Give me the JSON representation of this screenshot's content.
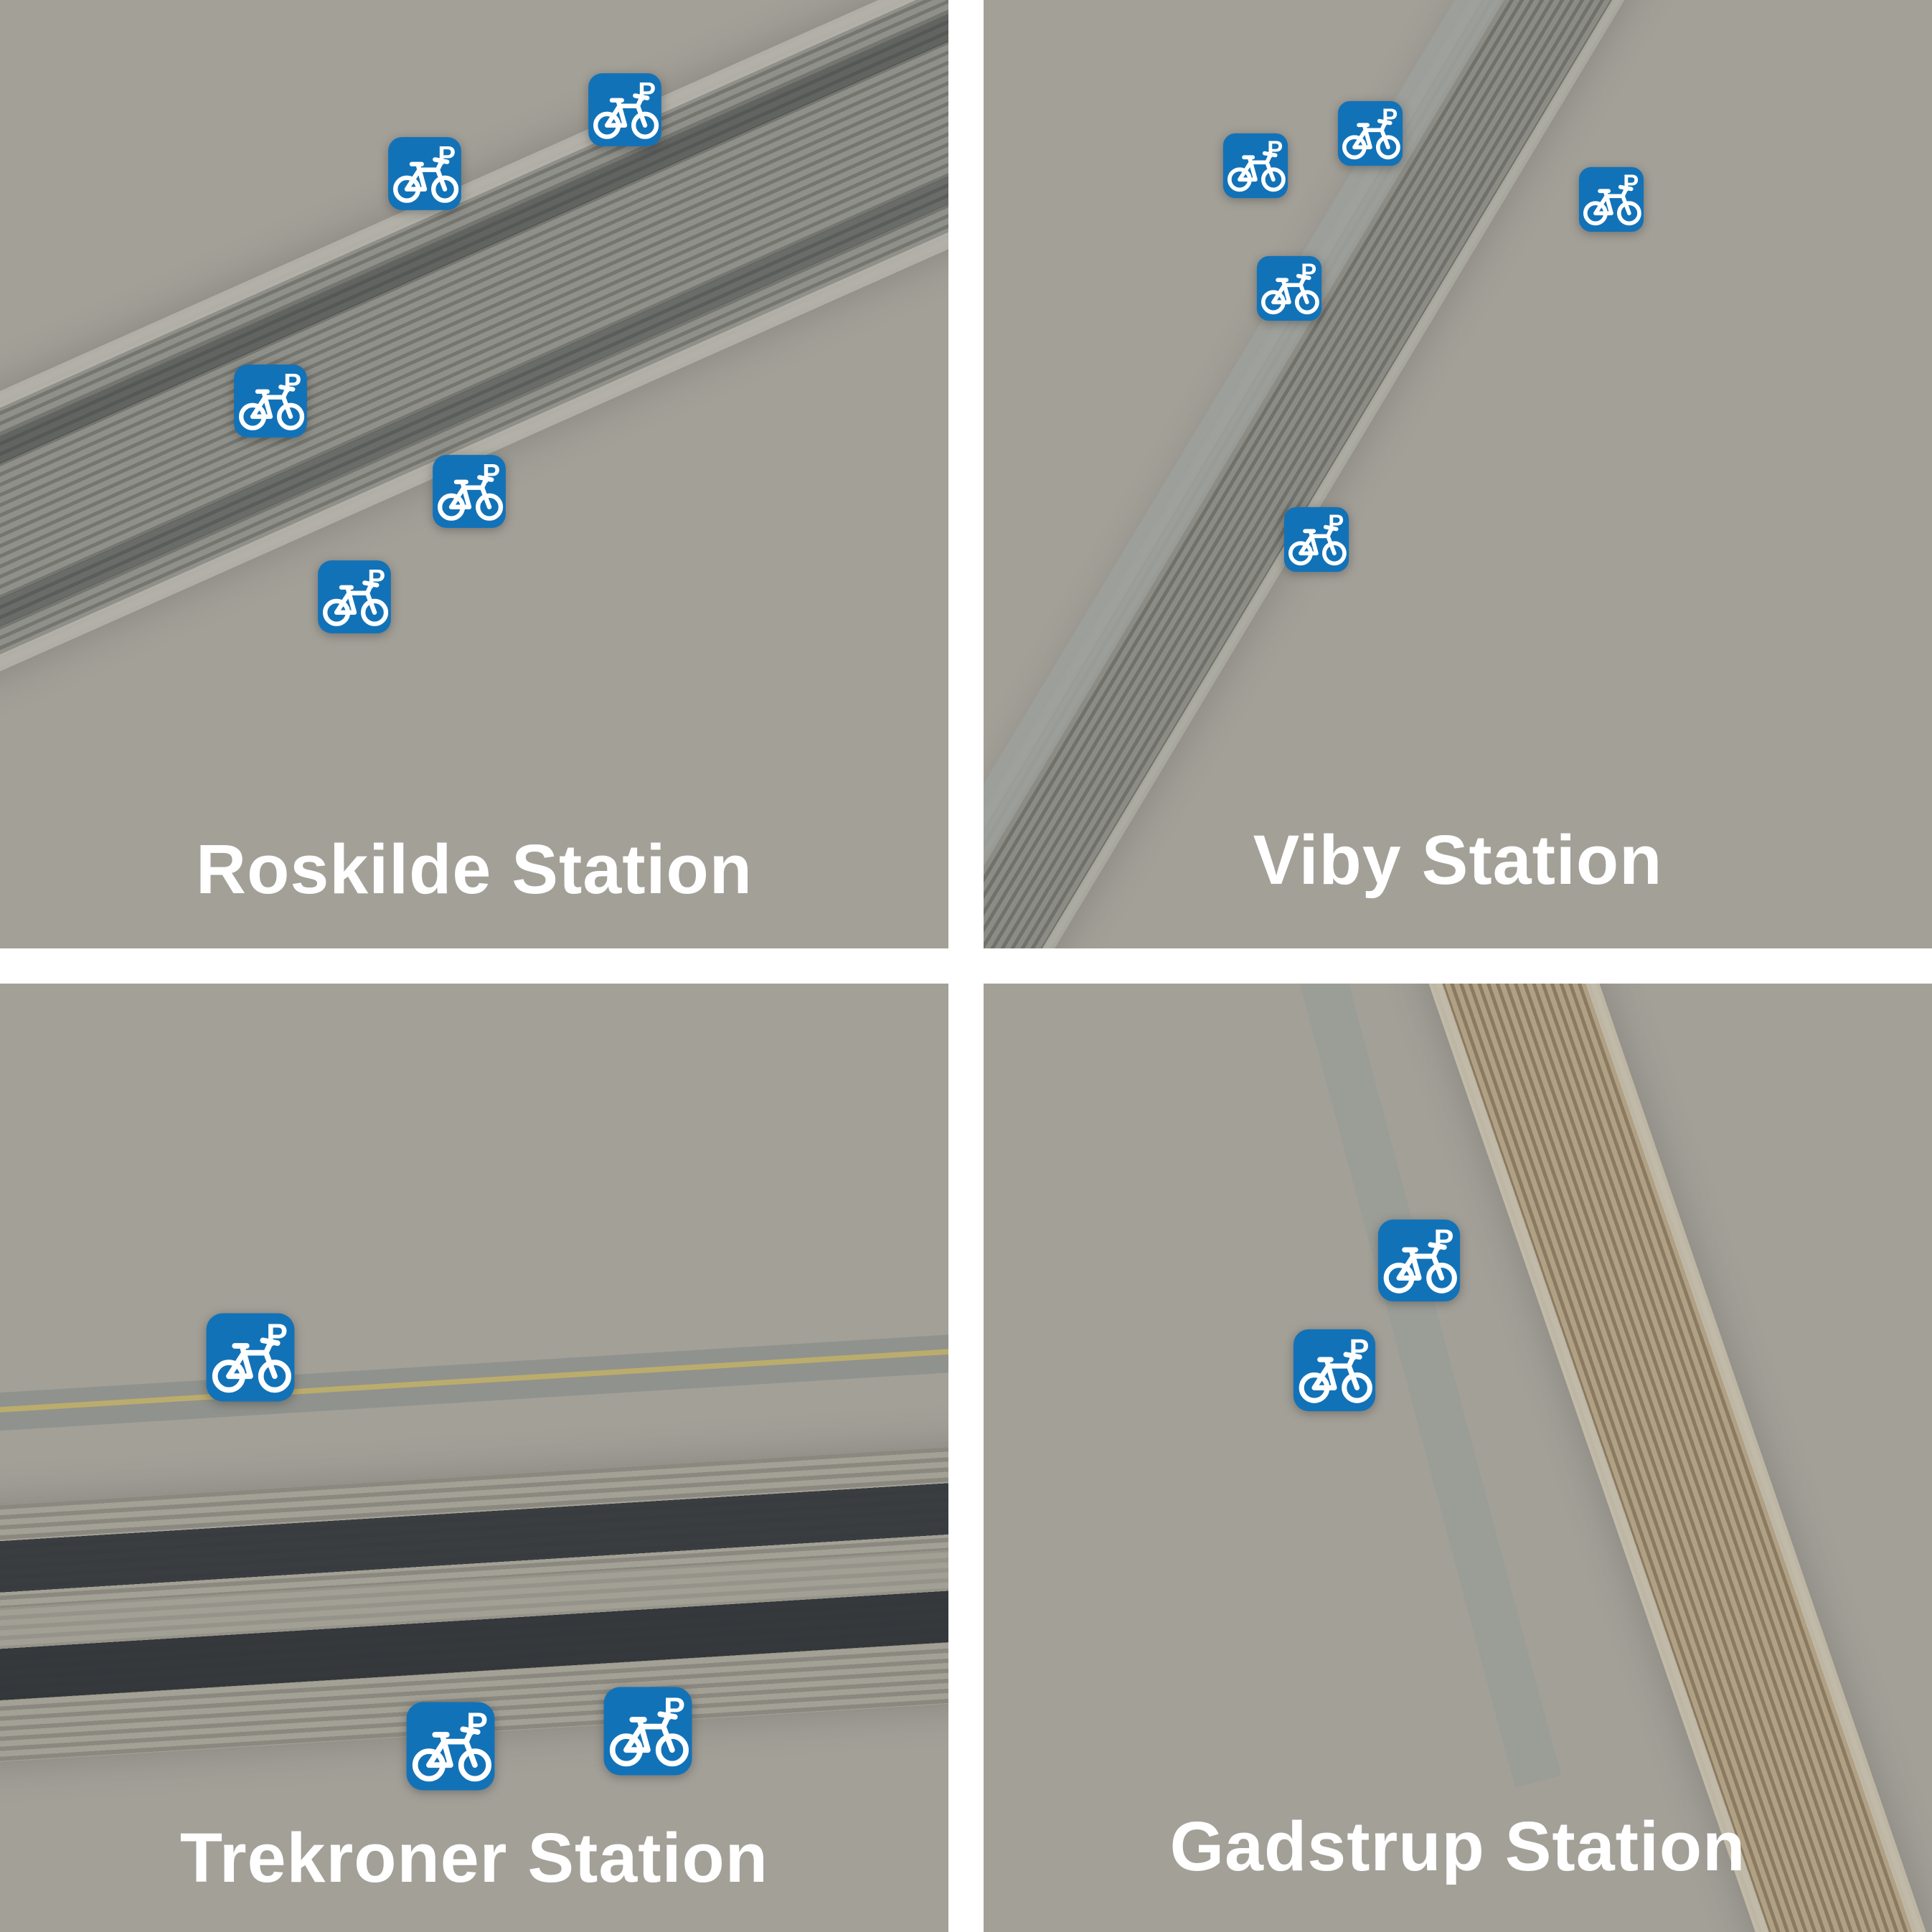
{
  "page": {
    "type": "bike-parking-stations-overview",
    "grid": "2x2"
  },
  "colors": {
    "accent_blue": "#1272b8",
    "icon_glyph": "#ffffff",
    "station_label": "#ffffff",
    "gutter": "#ffffff"
  },
  "marker": {
    "kind": "bicycle-parking-sign",
    "p_label": "P"
  },
  "quadrants": [
    {
      "id": "roskilde",
      "type": "aerial-orthophoto",
      "label": "Roskilde Station",
      "label_pos": {
        "x": 50,
        "y": 91.7
      },
      "marker_size_px": 106,
      "markers": [
        {
          "x": 65.9,
          "y": 11.6
        },
        {
          "x": 44.8,
          "y": 18.3
        },
        {
          "x": 28.5,
          "y": 42.3
        },
        {
          "x": 49.5,
          "y": 51.8
        },
        {
          "x": 37.4,
          "y": 62.9
        }
      ]
    },
    {
      "id": "viby",
      "type": "aerial-orthophoto",
      "label": "Viby Station",
      "label_pos": {
        "x": 49.3,
        "y": 90.7
      },
      "marker_size_px": 94,
      "markers": [
        {
          "x": 40.8,
          "y": 14.1
        },
        {
          "x": 28.7,
          "y": 17.5
        },
        {
          "x": 66.2,
          "y": 21.0
        },
        {
          "x": 32.2,
          "y": 30.4
        },
        {
          "x": 35.1,
          "y": 56.9
        }
      ]
    },
    {
      "id": "trekroner",
      "type": "aerial-orthophoto",
      "label": "Trekroner Station",
      "label_pos": {
        "x": 50.5,
        "y": 92.2
      },
      "marker_size_px": 128,
      "markers": [
        {
          "x": 26.4,
          "y": 39.4
        },
        {
          "x": 47.5,
          "y": 80.4
        },
        {
          "x": 68.3,
          "y": 78.8
        }
      ]
    },
    {
      "id": "gadstrup",
      "type": "aerial-orthophoto",
      "label": "Gadstrup Station",
      "label_pos": {
        "x": 49.6,
        "y": 91.0
      },
      "marker_size_px": 119,
      "markers": [
        {
          "x": 45.9,
          "y": 29.2
        },
        {
          "x": 37.0,
          "y": 40.8
        }
      ]
    }
  ]
}
